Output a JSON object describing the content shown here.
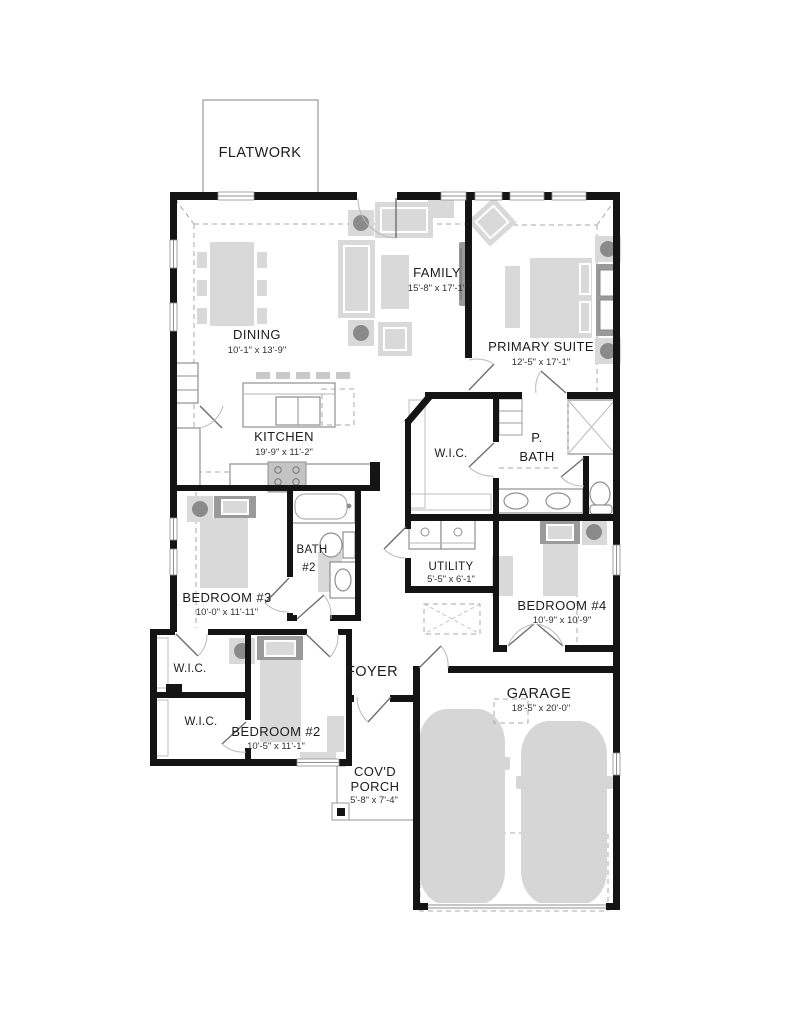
{
  "plan": {
    "flatwork": {
      "label": "FLATWORK"
    },
    "rooms": {
      "family": {
        "name": "FAMILY",
        "dims": "15'-8\" x 17'-1\""
      },
      "dining": {
        "name": "DINING",
        "dims": "10'-1\" x 13'-9\""
      },
      "primary": {
        "name": "PRIMARY SUITE",
        "dims": "12'-5\" x 17'-1\""
      },
      "kitchen": {
        "name": "KITCHEN",
        "dims": "19'-9\" x 11'-2\""
      },
      "wic_primary": {
        "name": "W.I.C."
      },
      "pbath": {
        "line1": "P.",
        "line2": "BATH"
      },
      "bath2": {
        "line1": "BATH",
        "line2": "#2"
      },
      "utility": {
        "name": "UTILITY",
        "dims": "5'-5\" x 6'-1\""
      },
      "bedroom3": {
        "name": "BEDROOM #3",
        "dims": "10'-0\" x 11'-11\""
      },
      "bedroom4": {
        "name": "BEDROOM #4",
        "dims": "10'-9\" x 10'-9\""
      },
      "wic1": {
        "name": "W.I.C."
      },
      "wic2": {
        "name": "W.I.C."
      },
      "foyer": {
        "name": "FOYER"
      },
      "bedroom2": {
        "name": "BEDROOM #2",
        "dims": "10'-5\" x 11'-1\""
      },
      "garage": {
        "name": "GARAGE",
        "dims": "18'-5\" x 20'-0\""
      },
      "porch": {
        "line1": "COV'D",
        "line2": "PORCH",
        "dims": "5'-8\" x 7'-4\""
      }
    },
    "colors": {
      "wall": "#141414",
      "furniture": "#d9d9d9",
      "furniture_dark": "#9a9a9a",
      "fixture_stroke": "#8f8f8f",
      "dashed_line": "#a8a8a8",
      "label": "#1c1c1c"
    }
  }
}
